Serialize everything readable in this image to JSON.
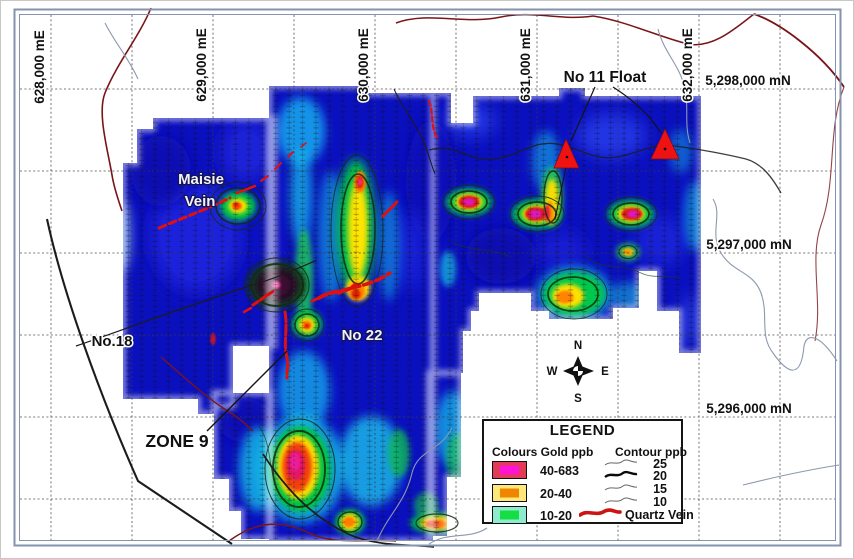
{
  "map": {
    "eastings": [
      {
        "label": "628,000 mE"
      },
      {
        "label": "629,000 mE"
      },
      {
        "label": "630,000 mE"
      },
      {
        "label": "631,000 mE"
      },
      {
        "label": "632,000 mE"
      }
    ],
    "northings": [
      {
        "label": "5,298,000 mN"
      },
      {
        "label": "5,297,000 mN"
      },
      {
        "label": "5,296,000 mN"
      }
    ],
    "annotations": {
      "maisie_vein_line1": "Maisie",
      "maisie_vein_line2": "Vein",
      "no18": "No.18",
      "no22": "No 22",
      "zone9": "ZONE 9",
      "no11_float": "No 11 Float"
    },
    "compass": {
      "n": "N",
      "e": "E",
      "s": "S",
      "w": "W"
    }
  },
  "legend": {
    "title": "LEGEND",
    "colours_header": "Colours Gold ppb",
    "contour_header": "Contour ppb",
    "classes": [
      {
        "range": "40-683",
        "outer": "#e23b55",
        "inner": "#ff14d6"
      },
      {
        "range": "20-40",
        "outer": "#ffe87a",
        "inner": "#f28500"
      },
      {
        "range": "10-20",
        "outer": "#8ceccd",
        "inner": "#17dd45"
      }
    ],
    "contours": [
      {
        "value": "25"
      },
      {
        "value": "20"
      },
      {
        "value": "15"
      },
      {
        "value": "10"
      }
    ],
    "quartz_vein_label": "Quartz Vein",
    "quartz_vein_color": "#cc1414"
  }
}
